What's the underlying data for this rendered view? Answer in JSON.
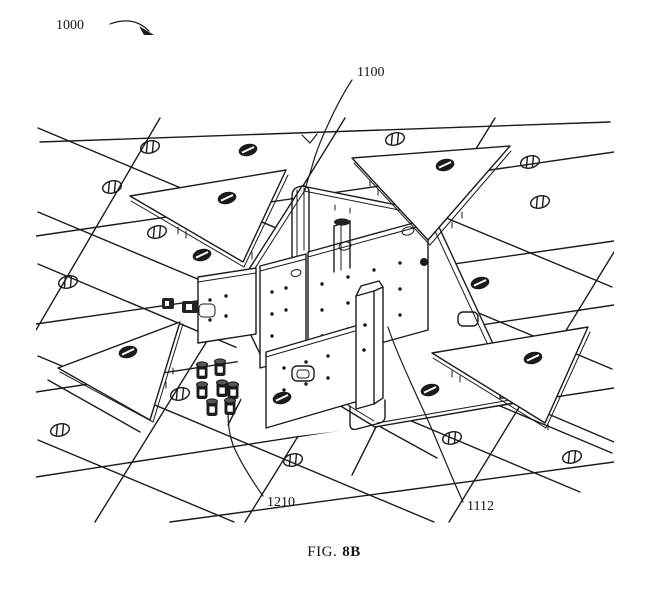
{
  "figure": {
    "background": "#ffffff",
    "ink": "#1b1b1b",
    "labels": {
      "assembly": "1000",
      "module": "1100",
      "spacers": "1210",
      "post": "1112"
    },
    "caption": {
      "prefix": "FIG.",
      "number": "8B"
    }
  }
}
